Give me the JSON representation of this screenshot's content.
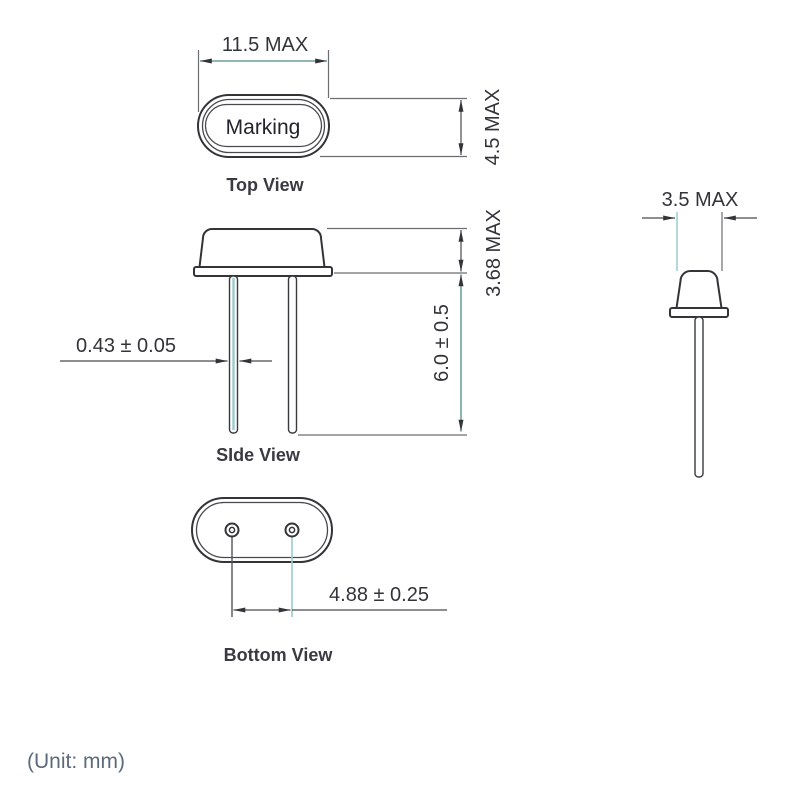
{
  "drawing_title": "Crystal package outline drawing",
  "unit_note": "(Unit: mm)",
  "colors": {
    "line": "#343438",
    "ext_line": "#6e6e70",
    "dim_teal": "#4d8b8b",
    "teal_light": "#9bcccc",
    "text": "#33333a",
    "label": "#3a3a42",
    "note": "#5c6b7b"
  },
  "top_view": {
    "label": "Top View",
    "marking": "Marking",
    "dim_width": "11.5 MAX",
    "dim_height": "4.5 MAX"
  },
  "side_view": {
    "label": "SIde View",
    "dim_can_height": "3.68 MAX",
    "dim_lead_length": "6.0 ± 0.5",
    "dim_lead_diameter": "0.43 ± 0.05"
  },
  "bottom_view": {
    "label": "Bottom View",
    "dim_pin_spacing": "4.88 ± 0.25"
  },
  "end_view": {
    "dim_width": "3.5 MAX"
  }
}
